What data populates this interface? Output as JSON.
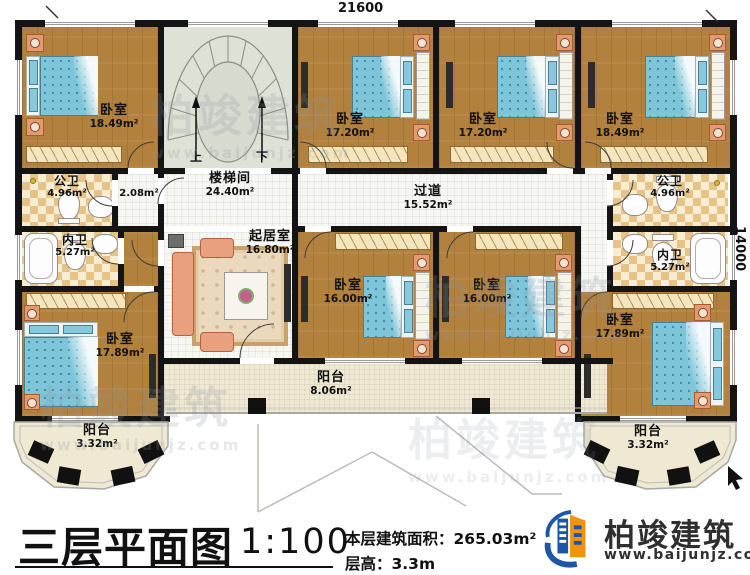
{
  "dimensions": {
    "width_mm": "21600",
    "height_mm": "14000"
  },
  "rooms": {
    "bedroom_top_left": {
      "name": "卧室",
      "area": "18.49m²"
    },
    "bedroom_top_mid_left": {
      "name": "卧室",
      "area": "17.20m²"
    },
    "bedroom_top_mid_right": {
      "name": "卧室",
      "area": "17.20m²"
    },
    "bedroom_top_right": {
      "name": "卧室",
      "area": "18.49m²"
    },
    "stairwell": {
      "name": "楼梯间",
      "area": "24.40m²",
      "up_label": "上",
      "down_label": "下"
    },
    "landing": {
      "area": "2.08m²"
    },
    "hallway": {
      "name": "过道",
      "area": "15.52m²"
    },
    "public_bath_left": {
      "name": "公卫",
      "area": "4.96m²"
    },
    "public_bath_right": {
      "name": "公卫",
      "area": "4.96m²"
    },
    "ensuite_bath_left": {
      "name": "内卫",
      "area": "5.27m²"
    },
    "ensuite_bath_right": {
      "name": "内卫",
      "area": "5.27m²"
    },
    "living_room": {
      "name": "起居室",
      "area": "16.80m²"
    },
    "bedroom_mid_left": {
      "name": "卧室",
      "area": "16.00m²"
    },
    "bedroom_mid_right": {
      "name": "卧室",
      "area": "16.00m²"
    },
    "bedroom_bottom_left": {
      "name": "卧室",
      "area": "17.89m²"
    },
    "bedroom_bottom_right": {
      "name": "卧室",
      "area": "17.89m²"
    },
    "balcony_center": {
      "name": "阳台",
      "area": "8.06m²"
    },
    "balcony_left": {
      "name": "阳台",
      "area": "3.32m²"
    },
    "balcony_right": {
      "name": "阳台",
      "area": "3.32m²"
    }
  },
  "title_block": {
    "title": "三层平面图",
    "scale": "1:100",
    "floor_area": "本层建筑面积：265.03m²",
    "floor_height": "层高：3.3m"
  },
  "branding": {
    "name": "柏竣建筑",
    "website": "www.baijunjz.com"
  },
  "watermark": {
    "text": "柏竣建筑",
    "url": "www.baijunjz.com"
  },
  "colors": {
    "wood": "#b2813e",
    "bed_blue": "#7ec5d9",
    "wall": "#141414",
    "checker": "#e7c387",
    "balcony": "#efe8d2",
    "brand_blue": "#1b57a5",
    "brand_orange": "#f2930f"
  }
}
